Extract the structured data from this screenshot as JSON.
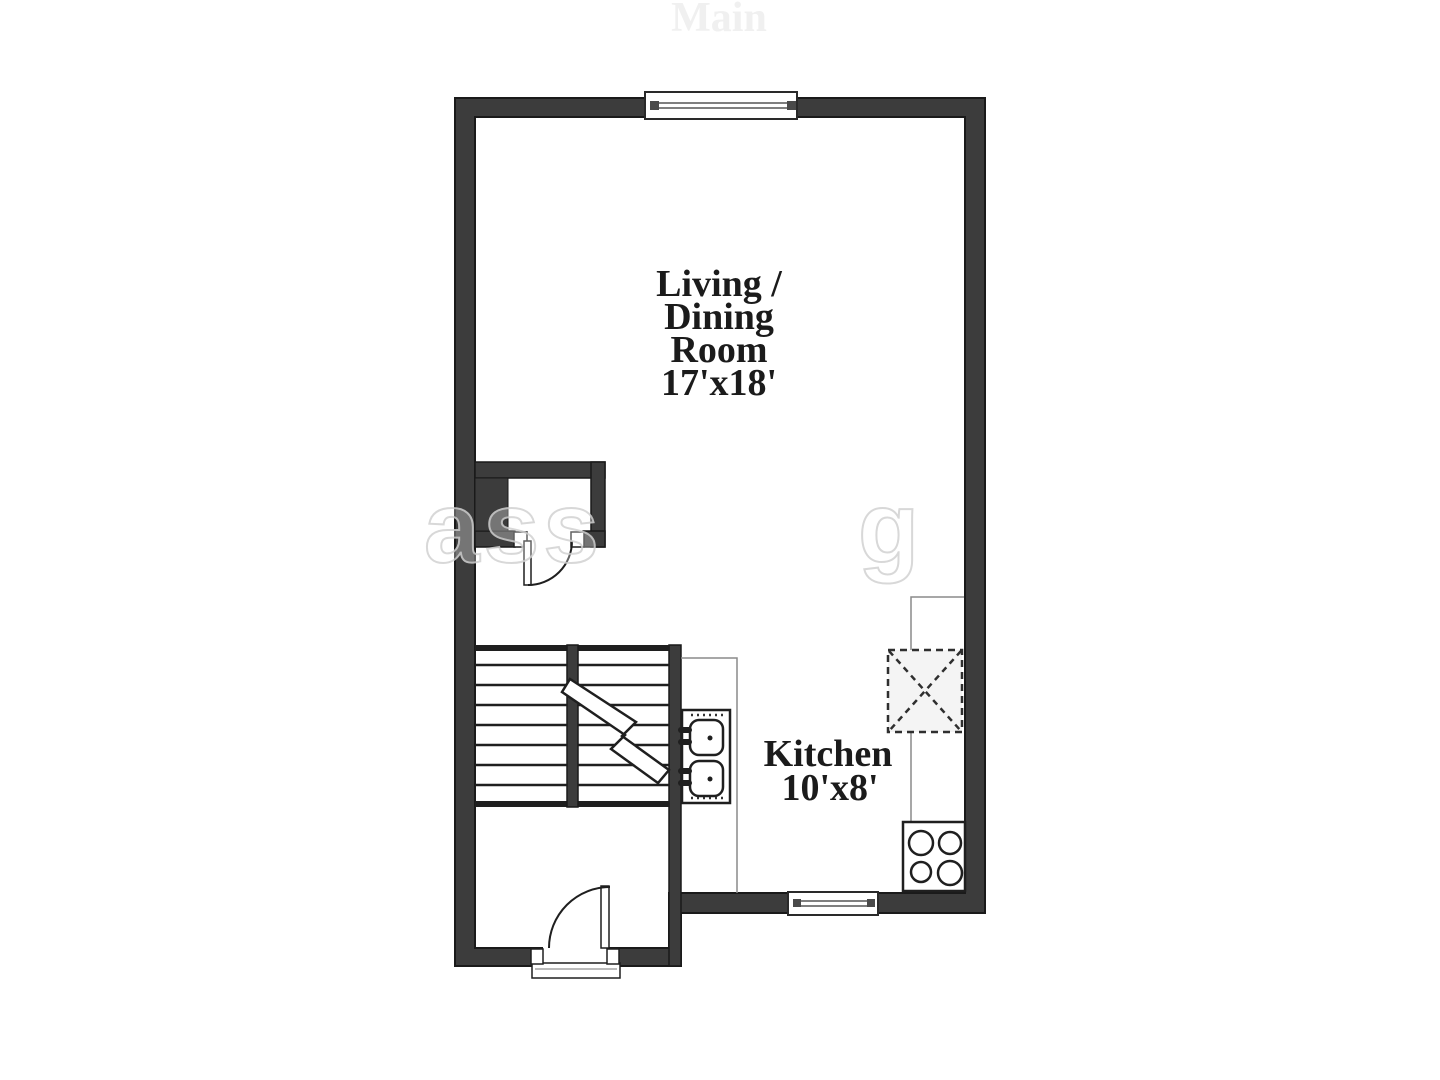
{
  "canvas": {
    "width": 1440,
    "height": 1080,
    "background": "#ffffff"
  },
  "plan": {
    "faint_title": "Main",
    "watermark_fragments": {
      "left": "ass",
      "right": "g"
    },
    "rooms": [
      {
        "name": "Living / Dining Room",
        "dimensions": "17'x18'",
        "label_lines": [
          "Living /",
          "Dining",
          "Room",
          "17'x18'"
        ]
      },
      {
        "name": "Kitchen",
        "dimensions": "10'x8'",
        "label_lines": [
          "Kitchen",
          "10'x8'"
        ]
      }
    ],
    "fixtures": [
      "closet",
      "stairs-double-flight",
      "stair-break-mark",
      "double-basin-sink",
      "four-burner-stove",
      "dashed-appliance-box",
      "kitchen-counter",
      "entry-door",
      "closet-door",
      "top-window",
      "bottom-window",
      "entry-threshold"
    ],
    "colors": {
      "wall": "#3c3c3c",
      "wall_outline": "#1a1a1a",
      "stair_line": "#1f1f1f",
      "counter_line": "#8a8a8a",
      "label_text": "#1b1b1b",
      "faint_title": "#f0f0f0",
      "watermark": "#d2d2d2",
      "appliance_fill": "#f4f4f4",
      "background": "#ffffff"
    }
  }
}
